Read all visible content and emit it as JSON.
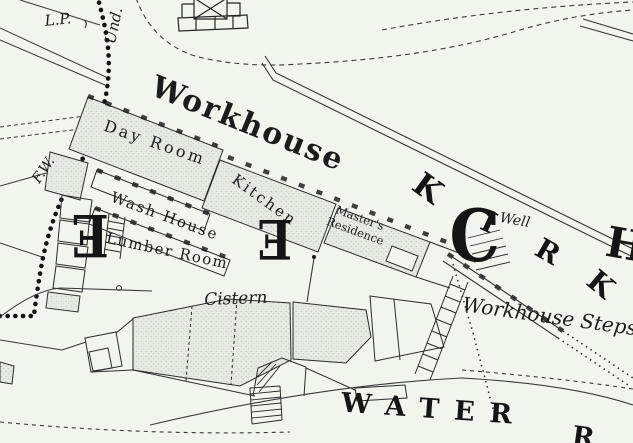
{
  "map": {
    "kind": "historic-town-plan",
    "colors": {
      "paper": "#f2f4ee",
      "ink": "#1e1e1e",
      "building_stipple": "#e7e9e3"
    },
    "annotations": {
      "lamp_post": "L.P.",
      "boundary_undefined": "Und.",
      "face_of_wall": "F.W.",
      "workhouse": "Workhouse",
      "day_room": "Day Room",
      "kitchen": "Kitchen",
      "wash_house": "Wash House",
      "lumber_room": "Lumber Room",
      "masters_residence": [
        "Master's",
        "Residence"
      ],
      "cistern": "Cistern",
      "well": "Well",
      "workhouse_steps": "Workhouse Steps"
    },
    "street_letters": {
      "kirk": [
        "K",
        "I",
        "R",
        "K"
      ],
      "partial_right": "H",
      "water": "WATER",
      "water_partial": "R"
    },
    "block_letters": [
      "E",
      "E",
      "C"
    ]
  }
}
